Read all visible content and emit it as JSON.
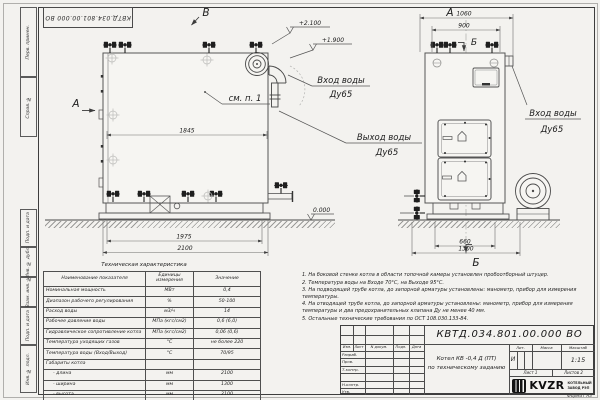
{
  "doc_number": "КВТД.034.801.00.000  ВО",
  "format_label": "Формат  А3",
  "margin_labels": [
    "Перв. примен.",
    "Справ. №",
    "Подп. и дата",
    "Инв. № дубл.",
    "Взам. инв. №",
    "Подп. и дата",
    "Инв. № подл."
  ],
  "views": {
    "view_a": "А",
    "view_b": "Б",
    "view_v": "В",
    "see_item": "см. п. 1"
  },
  "labels": {
    "water_inlet": "Вход воды",
    "water_outlet": "Выход воды",
    "dn65": "Ду65"
  },
  "elevations": {
    "top": "+2.100",
    "mid": "+1.900",
    "zero": "0.000"
  },
  "dims": {
    "d1845": "1845",
    "d1975": "1975",
    "d2100": "2100",
    "d1060": "1060",
    "d900": "900",
    "d660": "660",
    "d1300": "1300"
  },
  "table": {
    "title": "Техническая характеристика",
    "headers": [
      "Наименование показателя",
      "Единицы измерения",
      "Значение"
    ],
    "rows": [
      {
        "name": "Номинальная мощность",
        "unit": "МВт",
        "value": "0,4"
      },
      {
        "name": "Диапазон рабочего регулирования",
        "unit": "%",
        "value": "50-100"
      },
      {
        "name": "Расход воды",
        "unit": "м3/ч",
        "value": "14"
      },
      {
        "name": "Рабочее давление воды",
        "unit": "МПа (кгс/см2)",
        "value": "0,6 (6,0)"
      },
      {
        "name": "Гидравлическое сопротивление котла",
        "unit": "МПа (кгс/см2)",
        "value": "0,06 (0,6)"
      },
      {
        "name": "Температура уходящих газов",
        "unit": "°С",
        "value": "не более 220"
      },
      {
        "name": "Температура воды (Вход/Выход)",
        "unit": "°С",
        "value": "70/95"
      },
      {
        "name": "Габариты котла",
        "unit": "",
        "value": ""
      },
      {
        "name": "- длина",
        "unit": "мм",
        "value": "2100"
      },
      {
        "name": "- ширина",
        "unit": "мм",
        "value": "1300"
      },
      {
        "name": "- высота",
        "unit": "мм",
        "value": "2100"
      }
    ]
  },
  "notes": [
    "1. На боковой стенке котла в области топочной камеры установлен пробоотборный штуцер.",
    "2. Температура воды на Входе 70°С, на Выходе 95°С.",
    "3. На подводящей трубе котла, до запорной арматуры установлены: манометр, прибор для измерения температуры.",
    "4. На отводящей трубе котла, до запорной арматуры установлены: манометр, прибор для измерения температуры и два предохранительных клапана Ду не менее 40 мм.",
    "5. Остальные технические требования по ОСТ 108.030.133-84."
  ],
  "title_block": {
    "hdr_izm": "Изм.",
    "hdr_list": "Лист",
    "hdr_ndoc": "N докум.",
    "hdr_podp": "Подп.",
    "hdr_data": "Дата",
    "rows": [
      "Разраб.",
      "Пров.",
      "Т.контр.",
      "",
      "Н.контр.",
      "Утв."
    ],
    "name_line1": "Котел  КВ -0,4  Д  (ПТ)",
    "name_line2": "по техническому заданию",
    "lit_label": "Лит.",
    "massa_label": "Масса",
    "scale_label": "Масштаб",
    "lit_value": "И",
    "scale_value": "1:15",
    "sheet": "Лист  1",
    "sheets": "Листов  2",
    "logo_text": "KVZR",
    "logo_sub1": "КОТЕЛЬНЫЙ",
    "logo_sub2": "ЗАВОД РЭП"
  }
}
